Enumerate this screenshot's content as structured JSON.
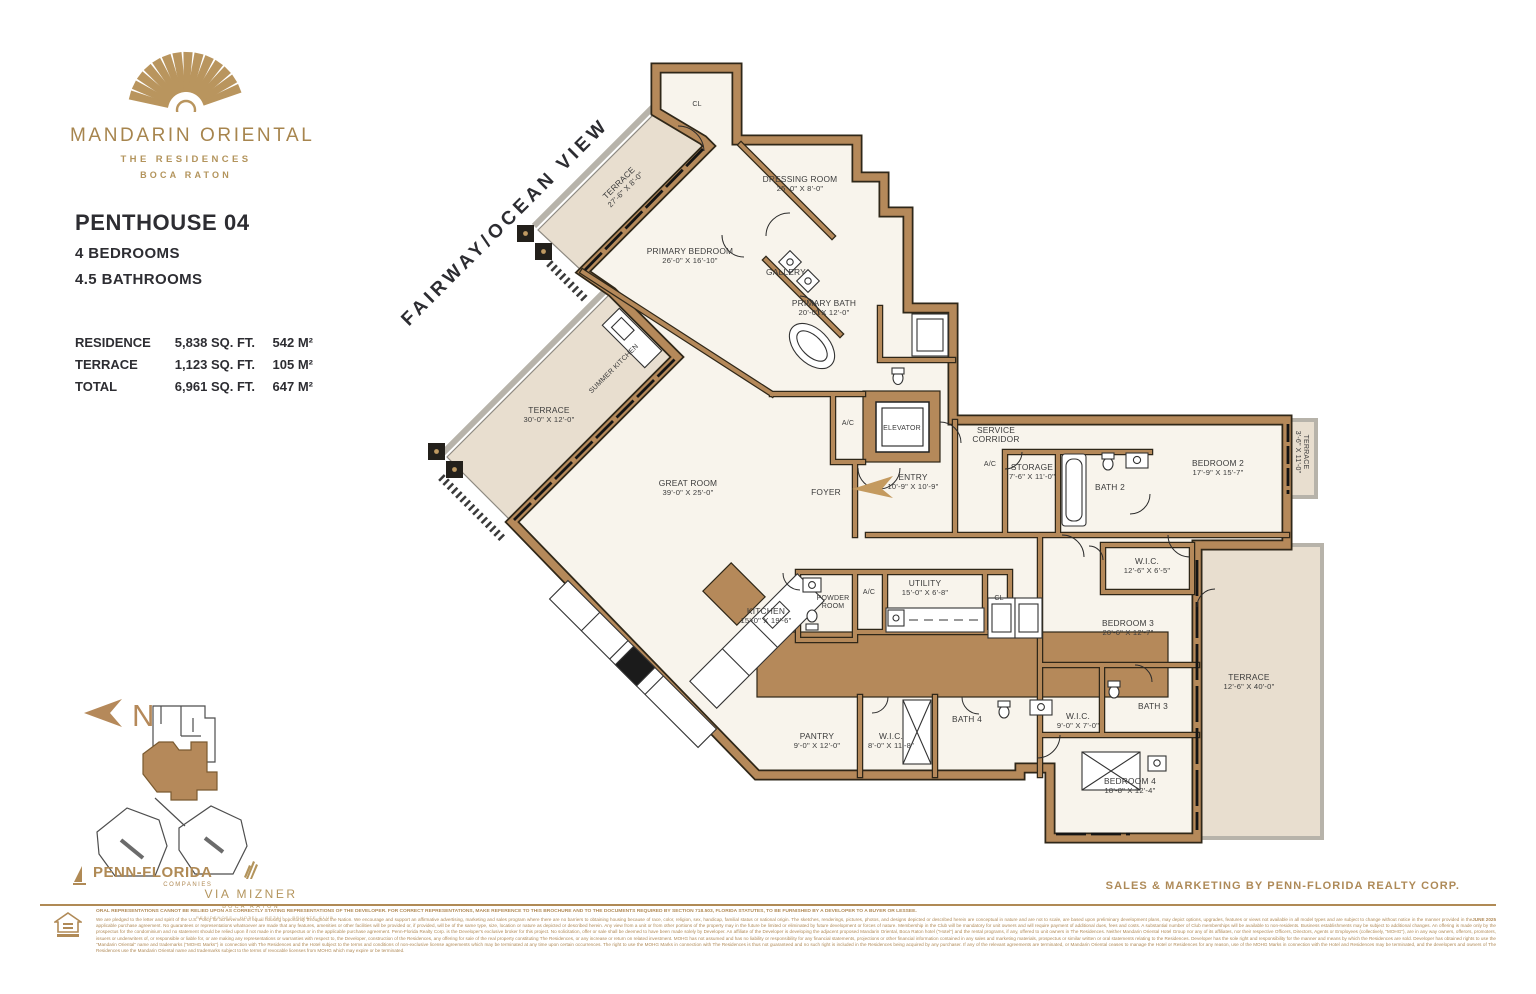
{
  "brand": {
    "name": "MANDARIN ORIENTAL",
    "sub1": "THE RESIDENCES",
    "sub2": "BOCA RATON"
  },
  "unit": {
    "title": "PENTHOUSE 04",
    "bedrooms": "4 BEDROOMS",
    "bathrooms": "4.5 BATHROOMS"
  },
  "areas": {
    "rows": [
      {
        "label": "RESIDENCE",
        "sqft": "5,838 SQ. FT.",
        "sqm": "542 M²"
      },
      {
        "label": "TERRACE",
        "sqft": "1,123 SQ. FT.",
        "sqm": "105 M²"
      },
      {
        "label": "TOTAL",
        "sqft": "6,961 SQ. FT.",
        "sqm": "647 M²"
      }
    ]
  },
  "plan": {
    "view_label": "FAIRWAY/OCEAN VIEW",
    "north_letter": "N",
    "rooms": [
      {
        "line1": "CL",
        "line2": ""
      },
      {
        "line1": "TERRACE",
        "line2": "27'-6\" X 8'-0\""
      },
      {
        "line1": "DRESSING ROOM",
        "line2": "25'-0\" X 8'-0\""
      },
      {
        "line1": "PRIMARY BEDROOM",
        "line2": "26'-0\" X 16'-10\""
      },
      {
        "line1": "GALLERY",
        "line2": ""
      },
      {
        "line1": "PRIMARY BATH",
        "line2": "20'-0\" X 12'-0\""
      },
      {
        "line1": "ELEVATOR",
        "line2": ""
      },
      {
        "line1": "A/C",
        "line2": ""
      },
      {
        "line1": "SERVICE",
        "line2": "CORRIDOR"
      },
      {
        "line1": "ENTRY",
        "line2": "10'-9\" X 10'-9\""
      },
      {
        "line1": "A/C",
        "line2": ""
      },
      {
        "line1": "STORAGE",
        "line2": "7'-6\" X 11'-0\""
      },
      {
        "line1": "BATH 2",
        "line2": ""
      },
      {
        "line1": "BEDROOM 2",
        "line2": "17'-9\" X 15'-7\""
      },
      {
        "line1": "TERRACE",
        "line2": "3'-6\" X 11'-0\""
      },
      {
        "line1": "W.I.C.",
        "line2": "12'-6\" X 6'-5\""
      },
      {
        "line1": "BEDROOM 3",
        "line2": "20'-6\" X 12'-7\""
      },
      {
        "line1": "TERRACE",
        "line2": "12'-6\" X 40'-0\""
      },
      {
        "line1": "FOYER",
        "line2": ""
      },
      {
        "line1": "GREAT ROOM",
        "line2": "39'-0\" X 25'-0\""
      },
      {
        "line1": "TERRACE",
        "line2": "30'-0\" X 12'-0\""
      },
      {
        "line1": "SUMMER KITCHEN",
        "line2": ""
      },
      {
        "line1": "KITCHEN",
        "line2": "15'-0\" X 19'-6\""
      },
      {
        "line1": "POWDER",
        "line2": "ROOM"
      },
      {
        "line1": "A/C",
        "line2": ""
      },
      {
        "line1": "UTILITY",
        "line2": "15'-0\" X 6'-8\""
      },
      {
        "line1": "CL",
        "line2": ""
      },
      {
        "line1": "PANTRY",
        "line2": "9'-0\" X 12'-0\""
      },
      {
        "line1": "W.I.C.",
        "line2": "8'-0\" X 11'-8\""
      },
      {
        "line1": "BATH 4",
        "line2": ""
      },
      {
        "line1": "W.I.C.",
        "line2": "9'-0\" X 7'-0\""
      },
      {
        "line1": "BATH 3",
        "line2": ""
      },
      {
        "line1": "BEDROOM 4",
        "line2": "18'-8\" X 12'-4\""
      }
    ]
  },
  "footer": {
    "penn_florida": "PENN-FLORIDA",
    "penn_florida_sub": "COMPANIES",
    "via_mizner": "VIA MIZNER",
    "via_mizner_sub": "BOCA RATON",
    "via_mizner_tagline": "RESIDENCES · HOTEL · RETAIL · PRIVATE CLUB",
    "sales_line": "SALES & MARKETING BY PENN-FLORIDA REALTY CORP.",
    "disclaimer_heading": "ORAL REPRESENTATIONS CANNOT BE RELIED UPON AS CORRECTLY STATING REPRESENTATIONS OF THE DEVELOPER. FOR CORRECT REPRESENTATIONS, MAKE REFERENCE TO THIS BROCHURE AND TO THE DOCUMENTS REQUIRED BY SECTION 718.503, FLORIDA STATUTES, TO BE FURNISHED BY A DEVELOPER TO A BUYER OR LESSEE.",
    "disclaimer_body": "We are pledged to the letter and spirit of the U.S. Policy for achievement of equal housing opportunity throughout the Nation. We encourage and support an affirmative advertising, marketing and sales program where there are no barriers to obtaining housing because of race, color, religion, sex, handicap, familial status or national origin. The sketches, renderings, pictures, photos, and designs depicted or described herein are conceptual in nature and are not to scale, are based upon preliminary development plans, may depict options, upgrades, features or views not available in all model types and are subject to change without notice in the manner provided in the applicable purchase agreement. No guarantees or representations whatsoever are made that any features, amenities or other facilities will be provided or, if provided, will be of the same type, size, location or nature as depicted or described herein. Any view from a unit or from other portions of the property may in the future be limited or eliminated by future development or forces of nature. Membership in the Club will be mandatory for unit owners and will require payment of additional dues, fees and costs. A substantial number of Club memberships will be available to non-residents. Business establishments may be subject to additional changes. An offering is made only by the prospectus for the condominium and no statement should be relied upon if not made in the prospectus or in the applicable purchase agreement. Penn-Florida Realty Corp. is the Developer's exclusive broker for this project. No solicitation, offer or sale shall be deemed to have been made solely by Developer. An affiliate of the Developer is developing the adjacent proposed Mandarin Oriental, Boca Raton hotel (\"Hotel\") and the rental programs, if any, offered to unit owners in The Residences. Neither Mandarin Oriental Hotel Group nor any of its affiliates, nor their respective Officers, Directors, Agents or Employees (collectively, \"MOHG\"), are in any way owners, offerors, promoters, issuers or underwriters of, or responsible or liable for, or are making any representations or warranties with respect to, the Developer, construction of the Residences, any offering for sale of the real property constituting The Residences, or any increase or return on related investment. MOHG has not assumed and has no liability or responsibility for any financial statements, projections or other financial information contained in any sales and marketing materials, prospectus or similar written or oral statements relating to the Residences. Developer has the sole right and responsibility for the manner and means by which the Residences are sold. Developer has obtained rights to use the \"Mandarin Oriental\" name and trademarks (\"MOHG Marks\") in connection with The Residences and the Hotel subject to the terms and conditions of non-exclusive license agreements which may be terminated at any time upon certain occurrences. The right to use the MOHG Marks in connection with The Residences is thus not guaranteed and no such right is included in the Residences being acquired by any purchaser. If any of the relevant agreements are terminated, or Mandarin Oriental ceases to manage the Hotel or Residences for any reason, use of the MOHG Marks in connection with the Hotel and Residences may be terminated, and the developers and owners of The Residences use the Mandarin Oriental name and trademarks subject to the terms of revocable licenses from MOHG which may expire or be terminated.",
    "date_code": "JUNE 2025"
  }
}
